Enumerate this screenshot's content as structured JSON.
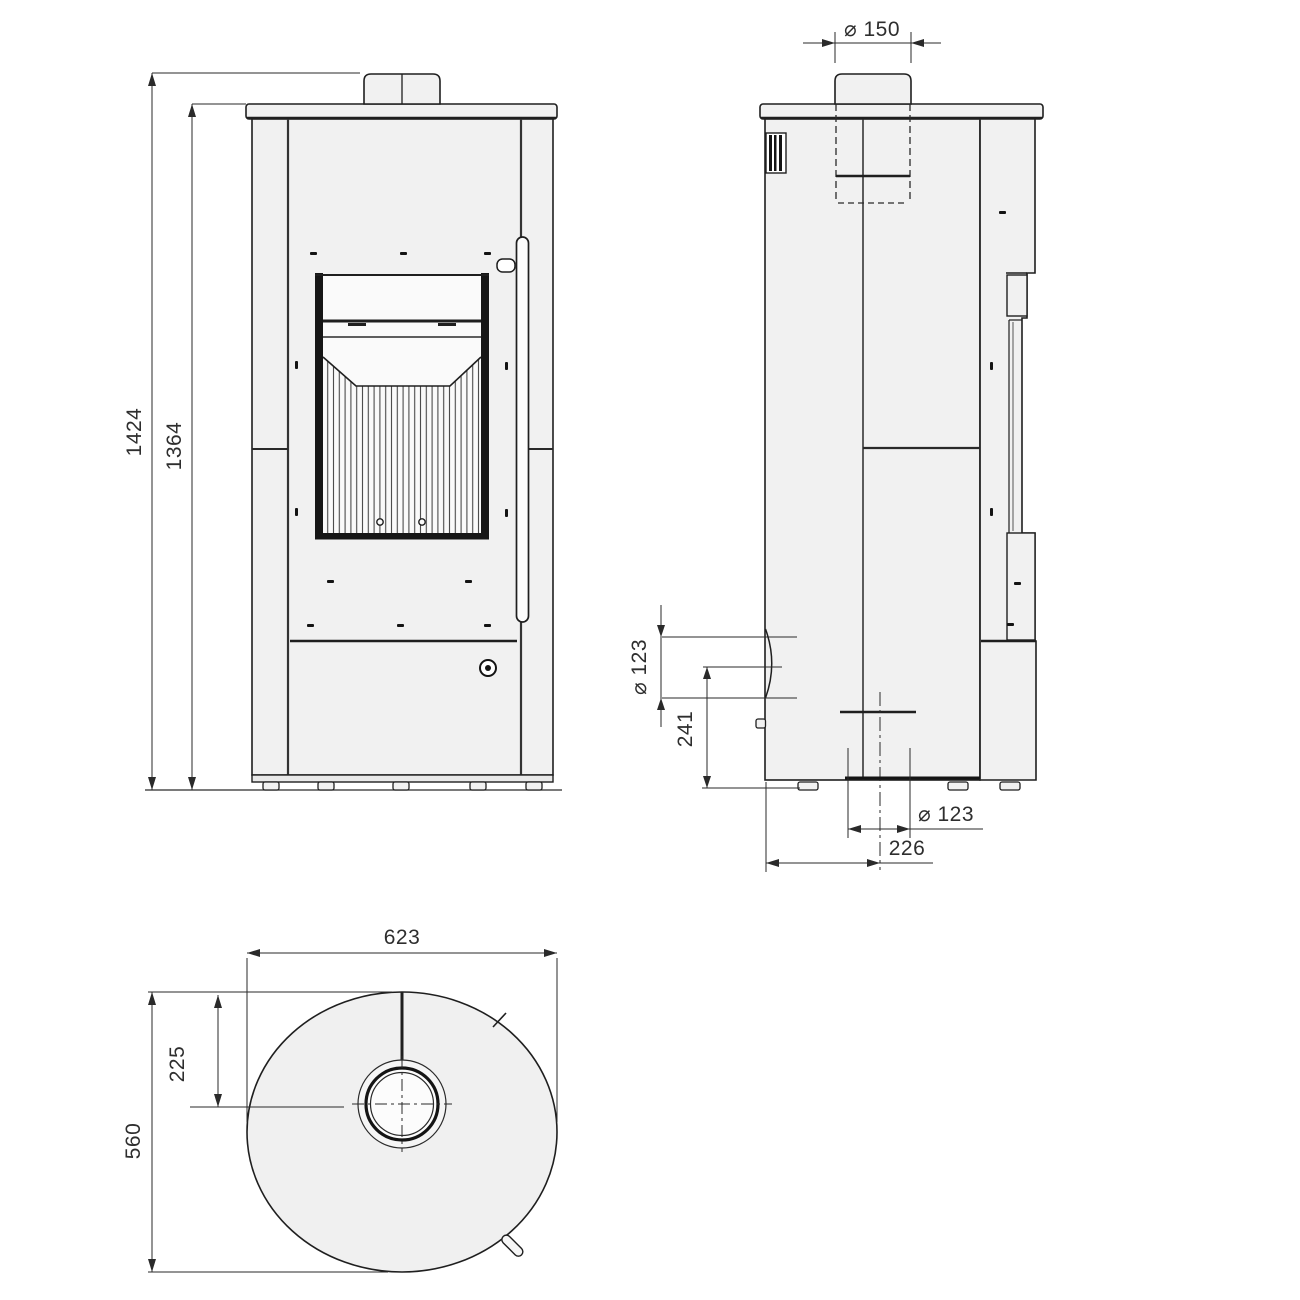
{
  "drawing": {
    "type": "stove technical drawing, three orthographic views",
    "front_view": {
      "overall_height": "1424",
      "body_height": "1364"
    },
    "side_view": {
      "flue_diameter": "⌀ 150",
      "rear_outlet_diameter": "⌀ 123",
      "rear_outlet_center_height": "241",
      "floor_outlet_diameter": "⌀ 123",
      "floor_outlet_center_from_back": "226"
    },
    "top_view": {
      "width": "623",
      "flue_center_offset": "225",
      "depth": "560"
    },
    "colors": {
      "line": "#1f1f1f",
      "panel_fill": "#f1f1f1",
      "glass_fill": "#fafafa",
      "dim_line": "#2a2a2a",
      "text": "#2e2e2e"
    }
  }
}
